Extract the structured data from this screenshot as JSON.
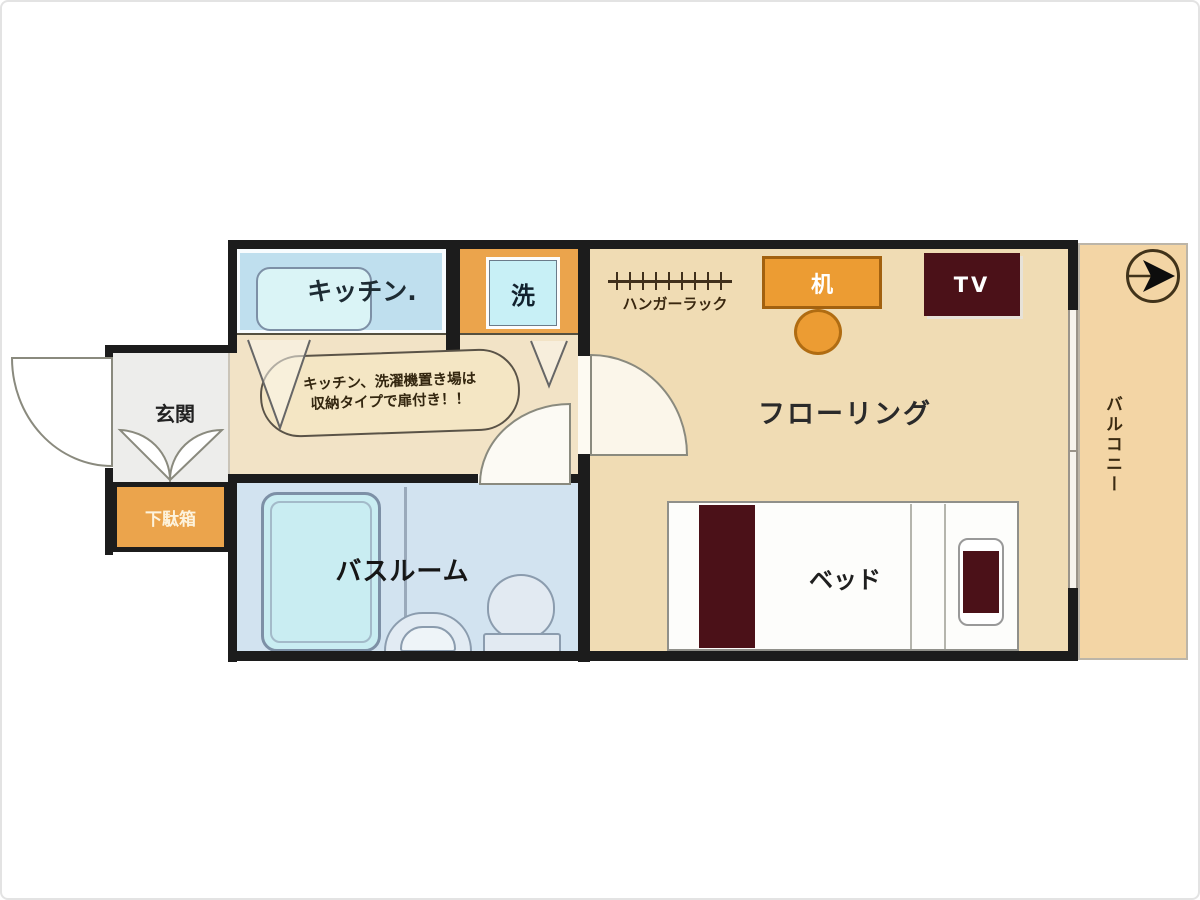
{
  "labels": {
    "kitchen": "キッチン.",
    "washer": "洗",
    "entrance": "玄関",
    "shoe_box": "下駄箱",
    "bathroom": "バスルーム",
    "flooring": "フローリング",
    "bed": "ベッド",
    "tv": "TV",
    "hanger_rack": "ハンガーラック",
    "balcony": "バルコニー",
    "desk_glyph": "机"
  },
  "bubble": {
    "line1": "キッチン、洗濯機置き場は",
    "line2": "収納タイプで扉付き！！"
  },
  "colors": {
    "wall": "#1c1c1c",
    "corridorTan": "#f2e3c6",
    "mainTan": "#f0dcb4",
    "balconyTan": "#f3d5a5",
    "bathBlue": "#d2e3f0",
    "tubCyan": "#c9edf2",
    "kitchenBlue": "#bfdfee",
    "orange": "#eba44c",
    "deskOrange": "#ec9c33",
    "maroon": "#4b1118",
    "entranceGrey": "#ededeb"
  }
}
